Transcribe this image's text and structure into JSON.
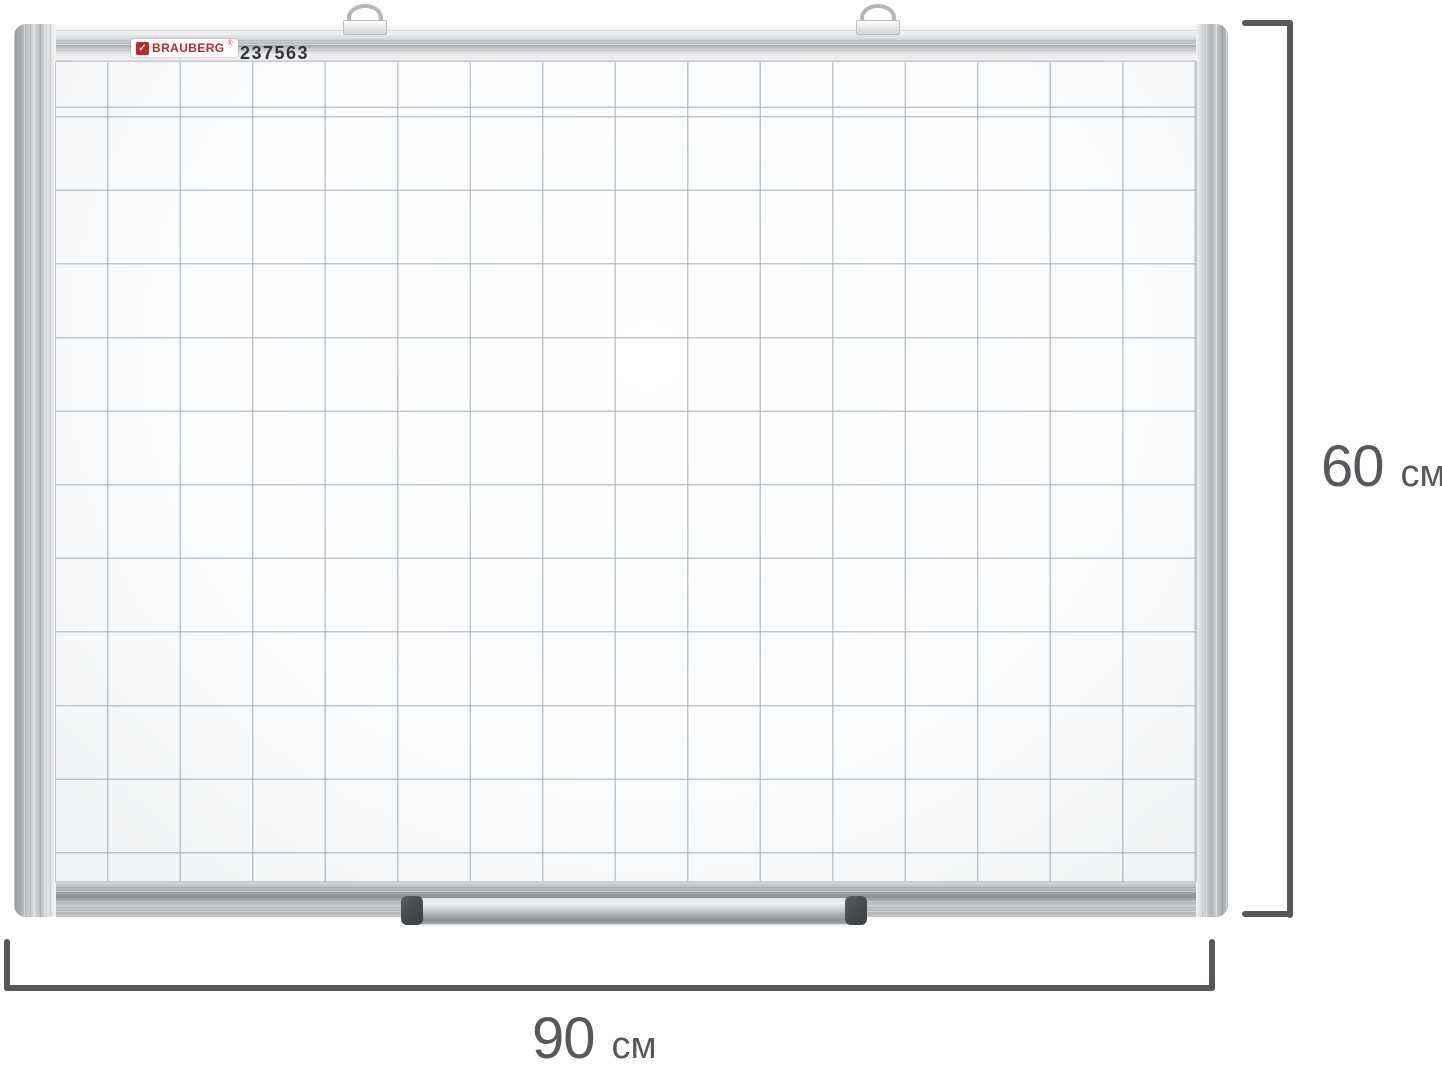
{
  "product_label": {
    "brand": "BRAUBERG",
    "registered_mark": "®",
    "article_number": "237563",
    "check_glyph": "✓",
    "brand_color": "#c8232b",
    "article_text_color": "#323438"
  },
  "dimensions": {
    "height": {
      "value": "60",
      "unit": "см"
    },
    "width": {
      "value": "90",
      "unit": "см"
    },
    "line_color": "#56585c",
    "text_color": "#56585c"
  },
  "whiteboard": {
    "frame_color": "#c9cbce",
    "corner_cap_color": "#63676c",
    "surface_color": "#fcfdfe",
    "grid_line_color": "#9eabb6",
    "hanger_count": 2
  }
}
